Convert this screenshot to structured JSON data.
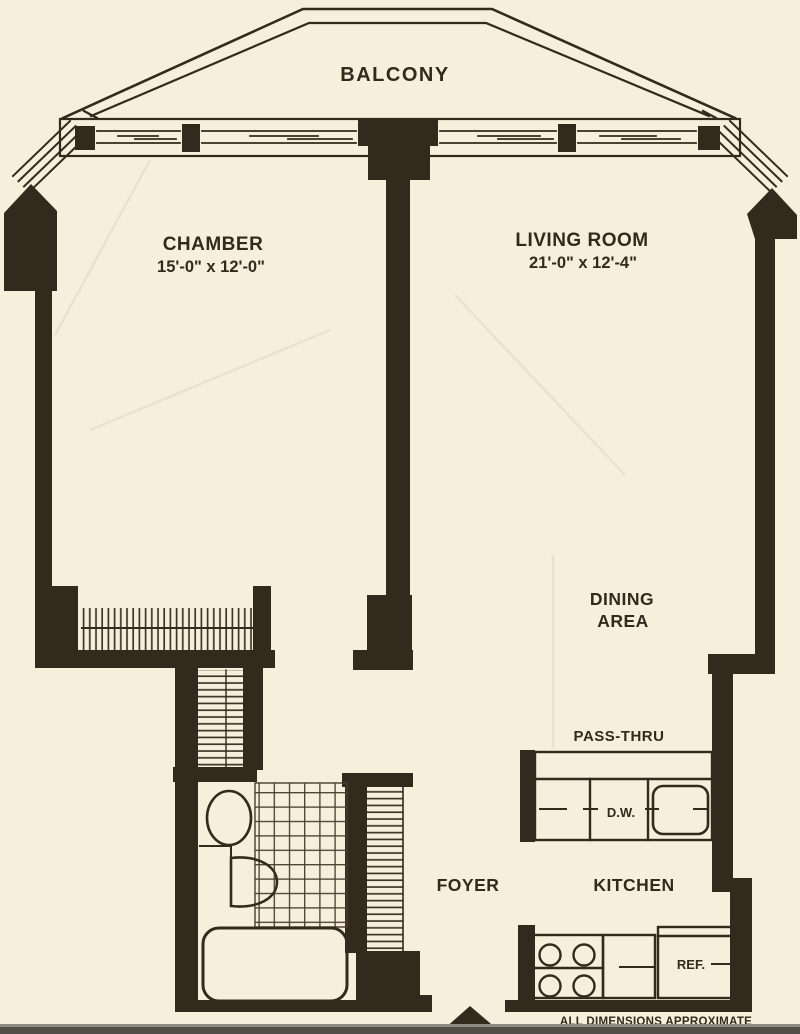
{
  "colors": {
    "paper": "#f6efdc",
    "ink": "#33291d",
    "crease": "#e8decb",
    "scan_bar": "#53504a",
    "scan_bar_top": "#8f8b80"
  },
  "rooms": {
    "balcony": {
      "label": "BALCONY"
    },
    "chamber": {
      "label": "CHAMBER",
      "dims": "15'-0\" x 12'-0\""
    },
    "living_room": {
      "label": "LIVING ROOM",
      "dims": "21'-0\" x 12'-4\""
    },
    "dining_area": {
      "label_line1": "DINING",
      "label_line2": "AREA"
    },
    "foyer": {
      "label": "FOYER"
    },
    "kitchen": {
      "label": "KITCHEN"
    }
  },
  "features": {
    "pass_thru": "PASS-THRU",
    "dishwasher": "D.W.",
    "refrigerator": "REF."
  },
  "footnote": "ALL DIMENSIONS APPROXIMATE"
}
